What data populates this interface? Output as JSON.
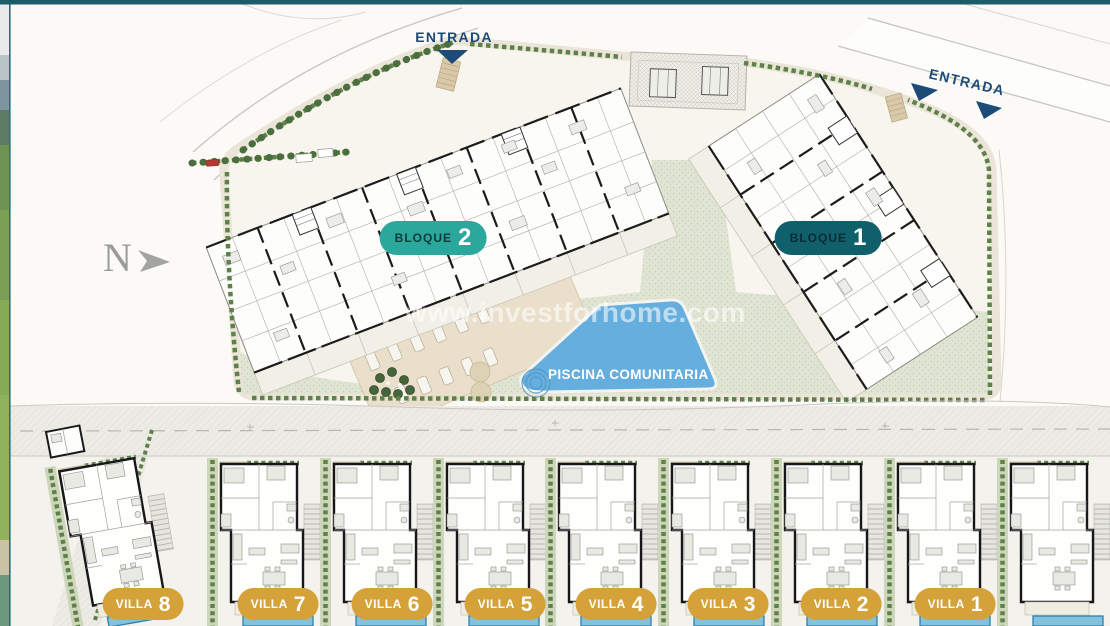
{
  "frame": {
    "top_bar_color": "#1b5e69",
    "edge_line_color": "#2a6f77"
  },
  "north_arrow": {
    "label": "N"
  },
  "entrances": {
    "top_left_label": "ENTRADA",
    "top_right_label": "ENTRADA",
    "arrow_color": "#1d4b78"
  },
  "blocks": {
    "bloque_2": {
      "name": "BLOQUE",
      "number": "2",
      "badge_color": "#2ba79b"
    },
    "bloque_1": {
      "name": "BLOQUE",
      "number": "1",
      "badge_color": "#10606c"
    }
  },
  "pool": {
    "label": "PISCINA COMUNITARIA",
    "water_color": "#66aedd"
  },
  "villas": {
    "badge_color": "#d5a23a",
    "private_pool_color": "#84c1dd",
    "items": [
      {
        "name": "VILLA",
        "number": "8"
      },
      {
        "name": "VILLA",
        "number": "7"
      },
      {
        "name": "VILLA",
        "number": "6"
      },
      {
        "name": "VILLA",
        "number": "5"
      },
      {
        "name": "VILLA",
        "number": "4"
      },
      {
        "name": "VILLA",
        "number": "3"
      },
      {
        "name": "VILLA",
        "number": "2"
      },
      {
        "name": "VILLA",
        "number": "1"
      }
    ]
  },
  "watermark": {
    "text": "www.investforhome.com"
  }
}
